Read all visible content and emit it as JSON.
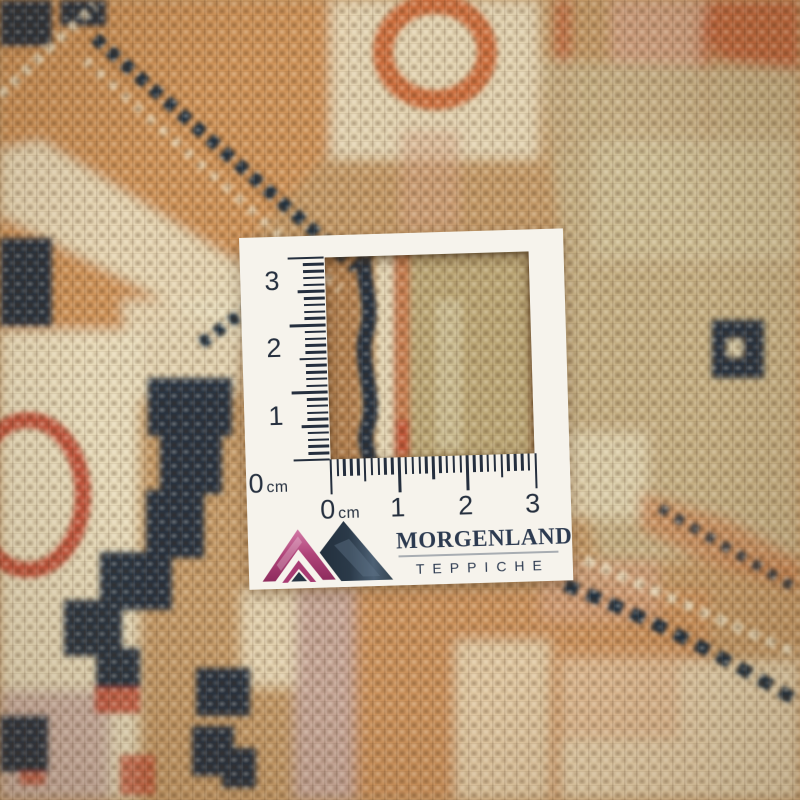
{
  "card": {
    "vertical_ruler": {
      "labels": [
        {
          "value": "3"
        },
        {
          "value": "2"
        },
        {
          "value": "1"
        },
        {
          "value": "0",
          "unit": "cm"
        }
      ]
    },
    "horizontal_ruler": {
      "labels": [
        {
          "value": "0",
          "unit": "cm"
        },
        {
          "value": "1"
        },
        {
          "value": "2"
        },
        {
          "value": "3"
        }
      ]
    },
    "brand": {
      "name": "MORGENLAND",
      "subtitle": "TEPPICHE",
      "logo_icon": "mountain-peaks-logo"
    }
  },
  "colors": {
    "card": "#f6f3ec",
    "ink": "#252f3e",
    "brand_text": "#2c3a50",
    "underline": "#a8adb2",
    "logo_pink": "#a83a72",
    "logo_pink_dark": "#8c2a5c",
    "logo_pink_light": "#d67fab",
    "logo_navy": "#273544",
    "logo_navy_light": "#55687c",
    "carpet_tan": "#c49a68",
    "carpet_orange": "#cf9257",
    "carpet_rust": "#c05a33",
    "carpet_cream": "#e8dcbd",
    "carpet_navy": "#22303f",
    "carpet_sage": "#c5b388",
    "carpet_salmon": "#d2a283",
    "carpet_mauve": "#c6a79e",
    "carpet_red": "#bf4930",
    "carpet_brown": "#b07c4c"
  }
}
